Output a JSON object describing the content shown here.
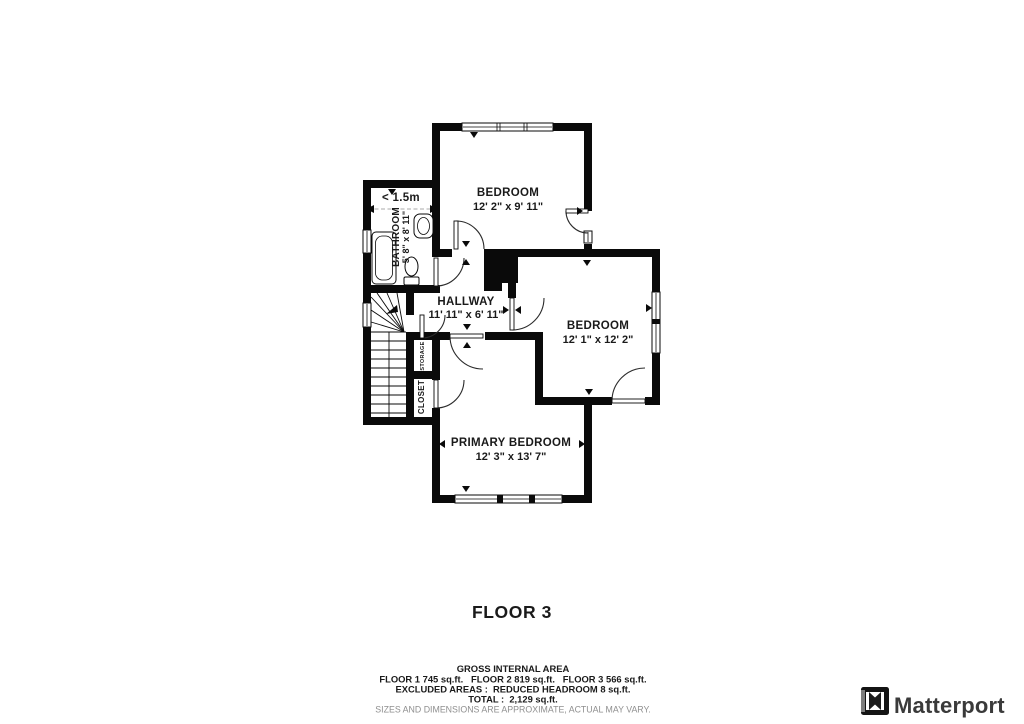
{
  "floor_label": "FLOOR 3",
  "plan": {
    "rooms": [
      {
        "name": "BEDROOM",
        "dims": "12' 2\" x 9' 11\""
      },
      {
        "name": "BEDROOM",
        "dims": "12' 1\" x 12' 2\""
      },
      {
        "name": "PRIMARY BEDROOM",
        "dims": "12' 3\" x 13' 7\""
      },
      {
        "name": "HALLWAY",
        "dims": "11' 11\" x 6' 11\""
      },
      {
        "name": "BATHROOM",
        "dims": "5' 8\" x 8' 11\""
      },
      {
        "name": "STORAGE"
      },
      {
        "name": "CLOSET"
      }
    ],
    "headroom_label": "< 1.5m"
  },
  "footer": {
    "title": "GROSS INTERNAL AREA",
    "areas_line": "FLOOR 1 745 sq.ft.   FLOOR 2 819 sq.ft.   FLOOR 3 566 sq.ft.",
    "excluded_line": "EXCLUDED AREAS :  REDUCED HEADROOM 8 sq.ft.",
    "total_line": "TOTAL :  2,129 sq.ft.",
    "disclaimer": "SIZES AND DIMENSIONS ARE APPROXIMATE, ACTUAL MAY VARY."
  },
  "brand": {
    "name": "Matterport"
  },
  "colors": {
    "wall": "#0a0a0a",
    "text": "#1a1a1a",
    "muted": "#8f8f8f",
    "brand_text": "#3a3a3a"
  }
}
